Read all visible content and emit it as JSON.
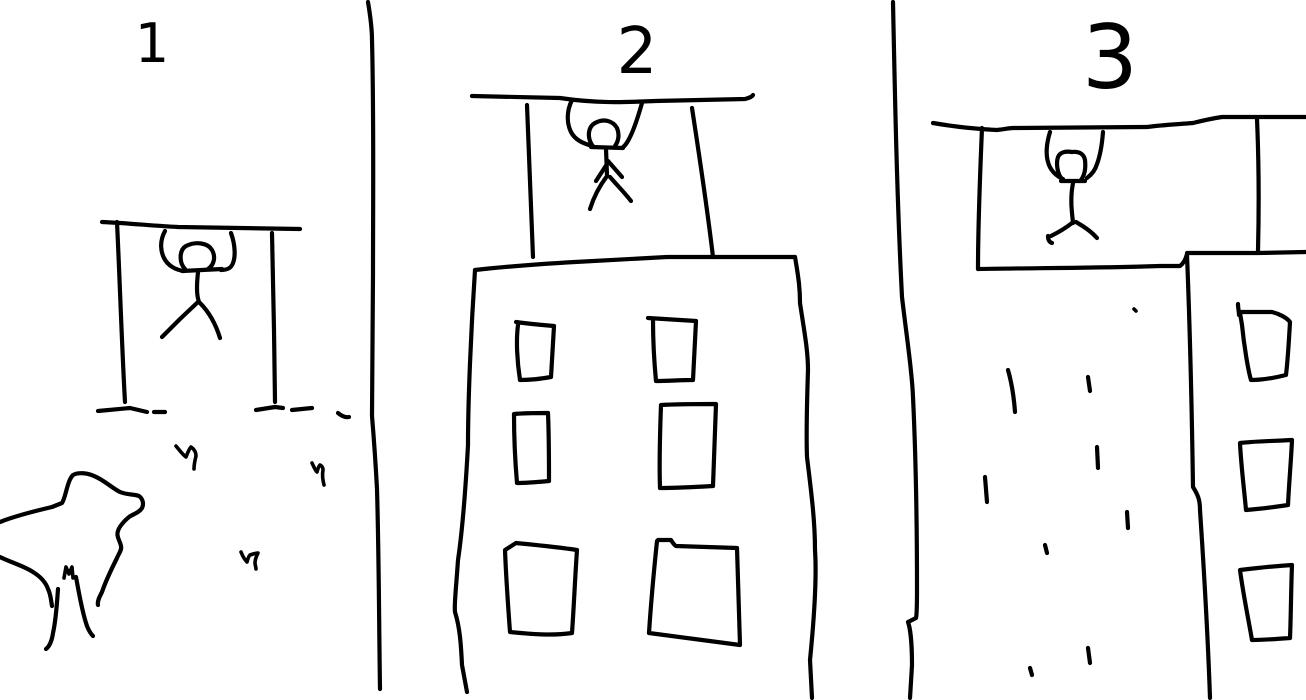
{
  "canvas": {
    "background": "#ffffff",
    "ink": "#000000"
  },
  "panels": [
    {
      "label": "1",
      "elements": [
        "pull-up-bar",
        "hanging-stick-figure",
        "dog",
        "bird-mark",
        "bird-mark",
        "bird-mark",
        "ground-dashes"
      ]
    },
    {
      "label": "2",
      "elements": [
        "overhead-ledge",
        "hanging-stick-figure",
        "building-facade",
        "windows-6"
      ]
    },
    {
      "label": "3",
      "elements": [
        "overhead-ledge",
        "hanging-stick-figure",
        "building-facade",
        "windows-3",
        "rain-dashes"
      ]
    }
  ]
}
